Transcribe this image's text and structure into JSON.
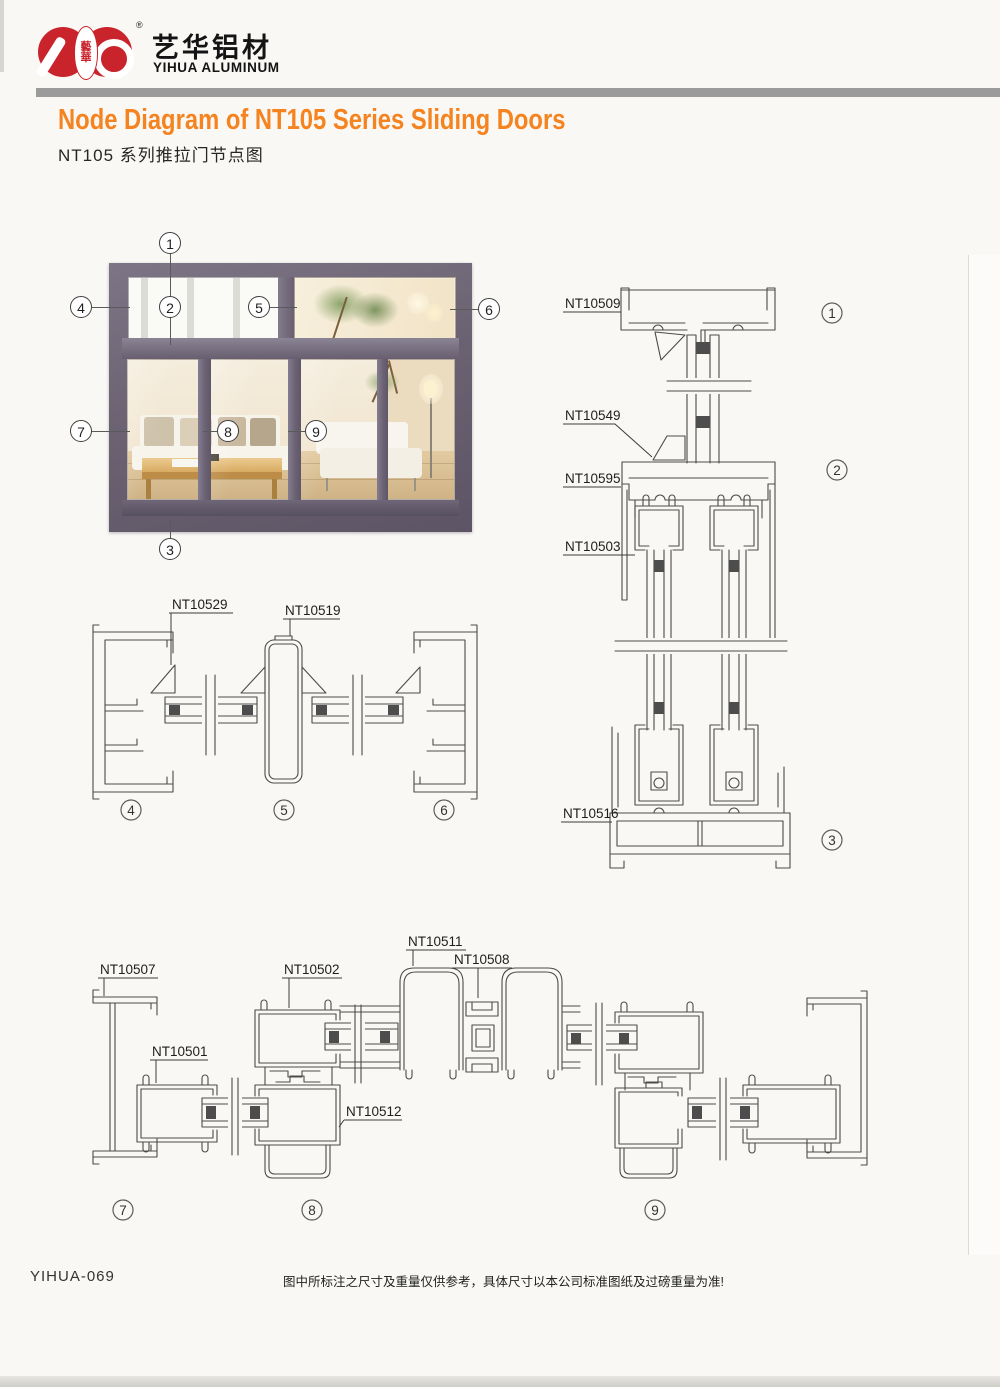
{
  "header": {
    "logo": {
      "seal_text_top": "藝",
      "seal_text_bottom": "華",
      "brand_cn": "艺华铝材",
      "brand_en": "YIHUA ALUMINUM",
      "registered": "®",
      "brand_color": "#c9232b"
    },
    "rule_color": "#9b9b9b"
  },
  "title": {
    "en": "Node Diagram of NT105 Series Sliding Doors",
    "cn": "NT105 系列推拉门节点图",
    "accent_color": "#f5831f"
  },
  "photo": {
    "frame_color": "#6b6372",
    "callouts": [
      "1",
      "2",
      "3",
      "4",
      "5",
      "6",
      "7",
      "8",
      "9"
    ]
  },
  "diagrams": {
    "vertical": {
      "labels": [
        "NT10509",
        "NT10549",
        "NT10595",
        "NT10503",
        "NT10516"
      ],
      "markers": [
        "1",
        "2",
        "3"
      ]
    },
    "transom": {
      "labels": [
        "NT10529",
        "NT10519"
      ],
      "markers": [
        "4",
        "5",
        "6"
      ]
    },
    "doors": {
      "labels": [
        "NT10507",
        "NT10501",
        "NT10502",
        "NT10511",
        "NT10508",
        "NT10512"
      ],
      "markers": [
        "7",
        "8",
        "9"
      ]
    }
  },
  "footer": {
    "code": "YIHUA-069",
    "disclaimer": "图中所标注之尺寸及重量仅供参考，具体尺寸以本公司标准图纸及过磅重量为准!"
  }
}
